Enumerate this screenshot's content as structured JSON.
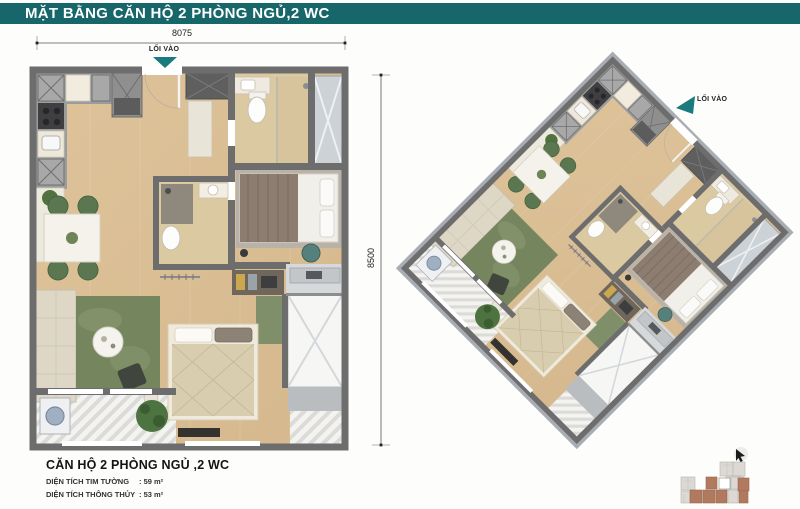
{
  "header": {
    "title": "MẶT BẰNG CĂN HỘ 2 PHÒNG NGỦ,2 WC"
  },
  "plan2d": {
    "entry_label": "LỐI VÀO",
    "width_dim": "8075",
    "height_dim": "8500"
  },
  "plan3d": {
    "entry_label": "LỐI VÀO"
  },
  "info": {
    "title": "CĂN HỘ 2 PHÒNG NGỦ ,2 WC",
    "rows": [
      {
        "label": "DIỆN TÍCH TIM TƯỜNG",
        "value": ": 59 m²"
      },
      {
        "label": "DIỆN TÍCH THÔNG THỦY",
        "value": ": 53 m²"
      }
    ]
  },
  "colors": {
    "banner_bg": "#17666a",
    "accent_teal": "#1a7a7d",
    "wall_gray": "#6d6d6d",
    "wood_floor": "#d9bc92",
    "bath_tile": "#dbc9a2",
    "rug_green": "#75865e",
    "keyplan_highlight": "#b17a5f"
  }
}
